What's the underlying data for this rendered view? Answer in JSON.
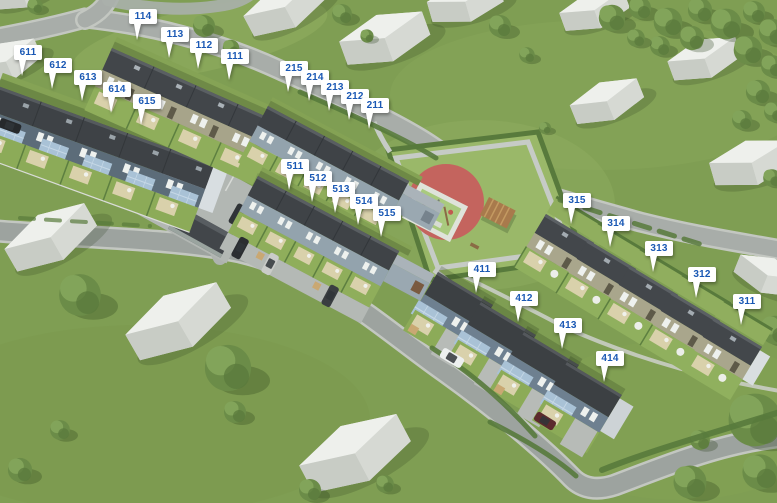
{
  "scene": {
    "type": "residential-development-aerial-site-plan",
    "marker": {
      "shape": "flag-pin",
      "bg": "#ffffff",
      "text_color": "#1a58b4"
    },
    "colors": {
      "grass": "#7f9e53",
      "garden_grass": "#8fae5b",
      "road": "#a6aba7",
      "roof_dark": "#3e4246",
      "wall_blue_grey": "#5c6c79",
      "wall_grey_green": "#93a3ad",
      "wall_beige": "#a7a48a",
      "porch_roof_blue": "#a9c2d6",
      "playground_red": "#c4645e",
      "playground_mat_green": "#a9ca7e",
      "hedge": "#587a3c",
      "background_building": "#dfe2dd"
    },
    "features": [
      "playground",
      "pergola",
      "parking-lot",
      "hedges",
      "trees",
      "roads",
      "background-buildings"
    ]
  },
  "markers": [
    {
      "label": "611"
    },
    {
      "label": "612"
    },
    {
      "label": "613"
    },
    {
      "label": "614"
    },
    {
      "label": "615"
    },
    {
      "label": "114"
    },
    {
      "label": "113"
    },
    {
      "label": "112"
    },
    {
      "label": "111"
    },
    {
      "label": "215"
    },
    {
      "label": "214"
    },
    {
      "label": "213"
    },
    {
      "label": "212"
    },
    {
      "label": "211"
    },
    {
      "label": "511"
    },
    {
      "label": "512"
    },
    {
      "label": "513"
    },
    {
      "label": "514"
    },
    {
      "label": "515"
    },
    {
      "label": "315"
    },
    {
      "label": "314"
    },
    {
      "label": "313"
    },
    {
      "label": "312"
    },
    {
      "label": "311"
    },
    {
      "label": "411"
    },
    {
      "label": "412"
    },
    {
      "label": "413"
    },
    {
      "label": "414"
    }
  ]
}
